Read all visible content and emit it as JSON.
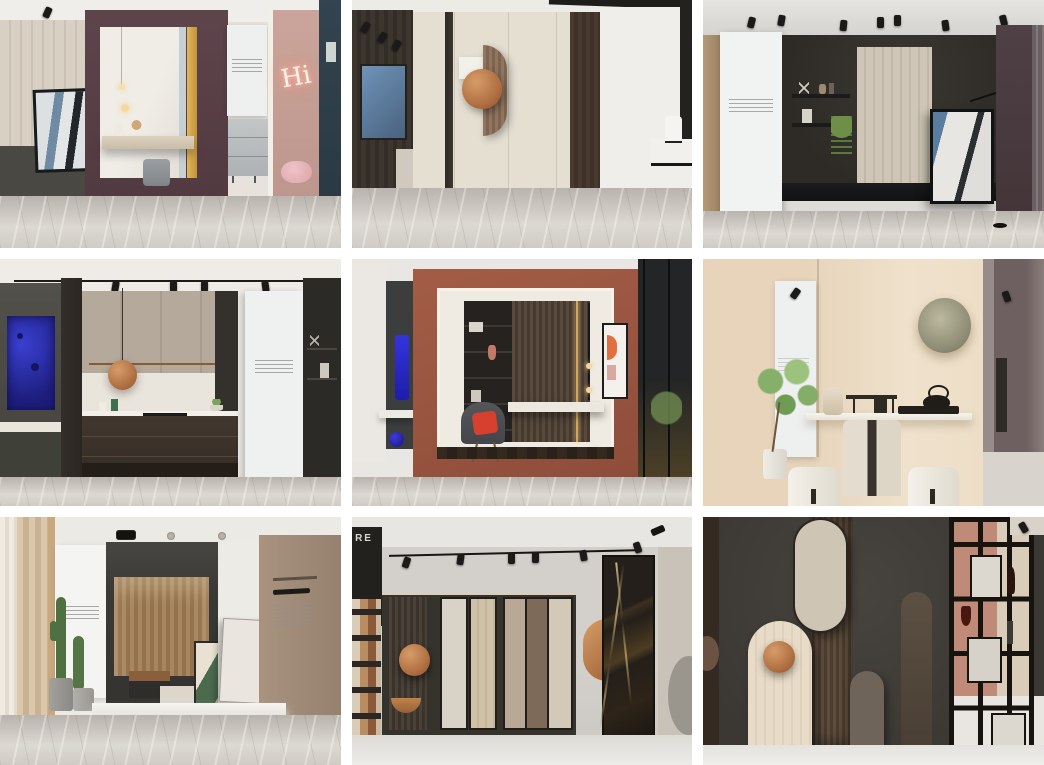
{
  "page": {
    "background": "#ffffff",
    "grid": {
      "rows": 3,
      "cols": 3,
      "gap_px": 11
    }
  },
  "tiles": [
    {
      "name": "vanity-niche-display",
      "neon_text": "Hi",
      "palette": {
        "box_frame_plum": "#58404a",
        "gold_strip": "#d3a343",
        "alcove_pink": "#c5a096",
        "end_wall_teal": "#30404b",
        "floor_marble": "#c9c4bd"
      }
    },
    {
      "name": "geometric-wall-art-hall",
      "palette": {
        "wall_cream": "#e5dfd2",
        "panel_dark_brown": "#46382e",
        "art_blue": "#5d81a6",
        "copper_disc": "#b5714c"
      }
    },
    {
      "name": "shelf-display-wall",
      "palette": {
        "wall_charcoal": "#33302c",
        "wood_panel": "#cdc4b5",
        "end_wall_plum": "#4b3d42",
        "plant_green": "#5e7d3e"
      }
    },
    {
      "name": "kitchen-display",
      "palette": {
        "base_cabinet": "#3c332c",
        "upper_cabinet_taupe": "#b2a698",
        "art_cobalt": "#2b2fae",
        "pendant_copper": "#c08448"
      }
    },
    {
      "name": "study-niche-display",
      "palette": {
        "box_frame_terracotta": "#9c5742",
        "cushion_red": "#d7402e",
        "panel_cobalt": "#2b2bd0",
        "slat_wall": "#4c3f33"
      }
    },
    {
      "name": "tea-room-display",
      "palette": {
        "wall_cream": "#eedfca",
        "moon_art_sage": "#949179",
        "table_marble": "#ded5c6",
        "teapot_black": "#201d19"
      }
    },
    {
      "name": "platform-display",
      "palette": {
        "wall_charcoal": "#3b3a37",
        "wood_slat": "#a08060",
        "wall_taupe": "#a18c7c",
        "cactus_green": "#4f7040"
      }
    },
    {
      "name": "tile-sample-wall",
      "sign_text": "RE",
      "palette": {
        "recess_charcoal": "#36322c",
        "copper_disc": "#c08448",
        "marble_black_gold": "#241f1a",
        "boards": [
          "#d9d2c6",
          "#cfc0a8",
          "#b9a896",
          "#7e6a58",
          "#d3c9b8"
        ]
      }
    },
    {
      "name": "arch-panel-display",
      "palette": {
        "wall_charcoal": "#413e39",
        "arch_cream": "#e6dac6",
        "copper_disc": "#bd7e4f",
        "back_wall_salmon": "#c08a78"
      }
    }
  ]
}
